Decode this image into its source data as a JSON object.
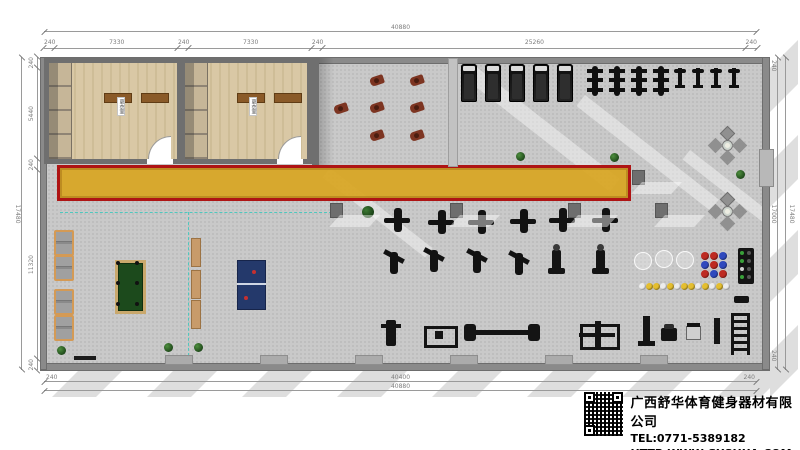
{
  "title_block": {
    "company_name": "广西舒华体育健身器材有限公司",
    "tel": "TEL:0771-5389182",
    "website": "HTTP:WWW.GXSHUA.COM"
  },
  "dimensions": {
    "top_total": "40880",
    "top_segments": [
      "240",
      "7330",
      "240",
      "7330",
      "240",
      "25260",
      "240"
    ],
    "bottom_inner": "40400",
    "bottom_inner_left_end": "240",
    "bottom_inner_right_end": "240",
    "bottom_total": "40880",
    "left_total": "17480",
    "left_segments": [
      "240",
      "5440",
      "240",
      "11320",
      "240"
    ],
    "right_inner": "17000",
    "right_outer": "17480",
    "right_top_end": "240",
    "right_bottom_end": "240"
  },
  "rooms": [
    {
      "label": "更衣室"
    },
    {
      "label": "更衣室"
    }
  ],
  "colors": {
    "track_fill": "#D8A626",
    "track_border": "#AE1414",
    "wood_floor": "#D8C7A4",
    "wall": "#8A8A8A",
    "floor": "#C9C9C9",
    "billiard_table": "#1C4A1C",
    "pingpong_table": "#24396B",
    "bench_wood": "#C89B6A",
    "zone_line": "#4FC8BE",
    "spin_bike": "#7D3522"
  },
  "plan": {
    "items": [
      {
        "t": "spin-bike",
        "x": 334,
        "y": 104
      },
      {
        "t": "spin-bike",
        "x": 370,
        "y": 76
      },
      {
        "t": "spin-bike",
        "x": 410,
        "y": 76
      },
      {
        "t": "spin-bike",
        "x": 370,
        "y": 103
      },
      {
        "t": "spin-bike",
        "x": 410,
        "y": 103
      },
      {
        "t": "spin-bike",
        "x": 370,
        "y": 131
      },
      {
        "t": "spin-bike",
        "x": 410,
        "y": 131
      },
      {
        "t": "treadmill",
        "x": 461,
        "y": 64
      },
      {
        "t": "treadmill",
        "x": 485,
        "y": 64
      },
      {
        "t": "treadmill",
        "x": 509,
        "y": 64
      },
      {
        "t": "treadmill",
        "x": 533,
        "y": 64
      },
      {
        "t": "treadmill",
        "x": 557,
        "y": 64
      },
      {
        "t": "elliptical",
        "x": 592,
        "y": 66
      },
      {
        "t": "elliptical",
        "x": 614,
        "y": 66
      },
      {
        "t": "elliptical",
        "x": 636,
        "y": 66
      },
      {
        "t": "elliptical",
        "x": 658,
        "y": 66
      },
      {
        "t": "gym-bike",
        "x": 678,
        "y": 68
      },
      {
        "t": "gym-bike",
        "x": 696,
        "y": 68
      },
      {
        "t": "gym-bike",
        "x": 714,
        "y": 68
      },
      {
        "t": "gym-bike",
        "x": 732,
        "y": 68
      },
      {
        "t": "machine-a",
        "x": 384,
        "y": 208
      },
      {
        "t": "machine-a",
        "x": 428,
        "y": 210
      },
      {
        "t": "machine-a",
        "x": 468,
        "y": 210
      },
      {
        "t": "machine-a",
        "x": 510,
        "y": 209
      },
      {
        "t": "machine-a",
        "x": 549,
        "y": 208
      },
      {
        "t": "machine-a",
        "x": 592,
        "y": 208
      },
      {
        "t": "machine-b",
        "x": 381,
        "y": 250
      },
      {
        "t": "machine-b",
        "x": 421,
        "y": 248
      },
      {
        "t": "machine-b",
        "x": 464,
        "y": 249
      },
      {
        "t": "machine-b",
        "x": 506,
        "y": 251
      },
      {
        "t": "pedestal",
        "x": 552,
        "y": 250
      },
      {
        "t": "pedestal",
        "x": 596,
        "y": 250
      },
      {
        "t": "bench-press",
        "x": 386,
        "y": 320
      },
      {
        "t": "plate-rack",
        "x": 424,
        "y": 326
      },
      {
        "t": "barbell-bench",
        "x": 470,
        "y": 330
      },
      {
        "t": "squat-rack",
        "x": 580,
        "y": 324
      },
      {
        "t": "post-a",
        "x": 643,
        "y": 316
      },
      {
        "t": "curl-bench",
        "x": 661,
        "y": 328
      },
      {
        "t": "chair-eq",
        "x": 686,
        "y": 326
      },
      {
        "t": "post-b",
        "x": 714,
        "y": 318
      },
      {
        "t": "ladder-rack",
        "x": 731,
        "y": 313
      },
      {
        "t": "db-rack",
        "x": 738,
        "y": 248
      },
      {
        "t": "small-eq",
        "x": 734,
        "y": 296
      },
      {
        "t": "doormat",
        "x": 74,
        "y": 356
      },
      {
        "t": "sofa",
        "x": 54,
        "y": 230
      },
      {
        "t": "sofa",
        "x": 54,
        "y": 255
      },
      {
        "t": "sofa",
        "x": 54,
        "y": 289
      },
      {
        "t": "sofa",
        "x": 54,
        "y": 315
      },
      {
        "t": "billiard",
        "x": 115,
        "y": 260
      },
      {
        "t": "pingpong",
        "x": 237,
        "y": 260
      },
      {
        "t": "wood-bench",
        "x": 191,
        "y": 238
      },
      {
        "t": "wood-bench",
        "x": 191,
        "y": 270
      },
      {
        "t": "wood-bench",
        "x": 191,
        "y": 300
      },
      {
        "t": "leisure",
        "x": 710,
        "y": 128
      },
      {
        "t": "leisure",
        "x": 710,
        "y": 194
      },
      {
        "t": "tree",
        "x": 362,
        "y": 206
      },
      {
        "t": "plant",
        "x": 610,
        "y": 153
      },
      {
        "t": "plant",
        "x": 516,
        "y": 152
      },
      {
        "t": "plant",
        "x": 736,
        "y": 170
      },
      {
        "t": "plant",
        "x": 57,
        "y": 346
      },
      {
        "t": "plant",
        "x": 164,
        "y": 343
      },
      {
        "t": "plant",
        "x": 194,
        "y": 343
      },
      {
        "t": "col",
        "x": 330,
        "y": 203
      },
      {
        "t": "col",
        "x": 450,
        "y": 203
      },
      {
        "t": "col",
        "x": 568,
        "y": 203
      },
      {
        "t": "col",
        "x": 655,
        "y": 203
      },
      {
        "t": "col",
        "x": 632,
        "y": 170
      },
      {
        "t": "pilaster",
        "x": 165,
        "y": 355
      },
      {
        "t": "pilaster",
        "x": 260,
        "y": 355
      },
      {
        "t": "pilaster",
        "x": 355,
        "y": 355
      },
      {
        "t": "pilaster",
        "x": 450,
        "y": 355
      },
      {
        "t": "pilaster",
        "x": 545,
        "y": 355
      },
      {
        "t": "pilaster",
        "x": 640,
        "y": 355
      },
      {
        "t": "ghost-ball",
        "x": 634,
        "y": 252
      },
      {
        "t": "ghost-ball",
        "x": 655,
        "y": 250
      },
      {
        "t": "ghost-ball",
        "x": 676,
        "y": 251
      },
      {
        "t": "ball",
        "x": 701,
        "y": 252,
        "w": 8,
        "h": 8,
        "c": "#BE2B22"
      },
      {
        "t": "ball",
        "x": 710,
        "y": 252,
        "w": 8,
        "h": 8,
        "c": "#BE2B22"
      },
      {
        "t": "ball",
        "x": 719,
        "y": 252,
        "w": 8,
        "h": 8,
        "c": "#2F49BE"
      },
      {
        "t": "ball",
        "x": 701,
        "y": 261,
        "w": 8,
        "h": 8,
        "c": "#2F49BE"
      },
      {
        "t": "ball",
        "x": 710,
        "y": 261,
        "w": 8,
        "h": 8,
        "c": "#BE2B22"
      },
      {
        "t": "ball",
        "x": 719,
        "y": 261,
        "w": 8,
        "h": 8,
        "c": "#2F49BE"
      },
      {
        "t": "ball",
        "x": 701,
        "y": 270,
        "w": 8,
        "h": 8,
        "c": "#BE2B22"
      },
      {
        "t": "ball",
        "x": 710,
        "y": 270,
        "w": 8,
        "h": 8,
        "c": "#2F49BE"
      },
      {
        "t": "ball",
        "x": 719,
        "y": 270,
        "w": 8,
        "h": 8,
        "c": "#BE2B22"
      },
      {
        "t": "ball",
        "x": 639,
        "y": 283,
        "w": 7,
        "h": 7,
        "c": "#ECECEC"
      },
      {
        "t": "ball",
        "x": 646,
        "y": 283,
        "w": 7,
        "h": 7,
        "c": "#E4BE2F"
      },
      {
        "t": "ball",
        "x": 653,
        "y": 283,
        "w": 7,
        "h": 7,
        "c": "#E4BE2F"
      },
      {
        "t": "ball",
        "x": 660,
        "y": 283,
        "w": 7,
        "h": 7,
        "c": "#ECECEC"
      },
      {
        "t": "ball",
        "x": 667,
        "y": 283,
        "w": 7,
        "h": 7,
        "c": "#E4BE2F"
      },
      {
        "t": "ball",
        "x": 674,
        "y": 283,
        "w": 7,
        "h": 7,
        "c": "#ECECEC"
      },
      {
        "t": "ball",
        "x": 681,
        "y": 283,
        "w": 7,
        "h": 7,
        "c": "#E4BE2F"
      },
      {
        "t": "ball",
        "x": 688,
        "y": 283,
        "w": 7,
        "h": 7,
        "c": "#E4BE2F"
      },
      {
        "t": "ball",
        "x": 695,
        "y": 283,
        "w": 7,
        "h": 7,
        "c": "#ECECEC"
      },
      {
        "t": "ball",
        "x": 702,
        "y": 283,
        "w": 7,
        "h": 7,
        "c": "#E4BE2F"
      },
      {
        "t": "ball",
        "x": 709,
        "y": 283,
        "w": 7,
        "h": 7,
        "c": "#ECECEC"
      },
      {
        "t": "ball",
        "x": 716,
        "y": 283,
        "w": 7,
        "h": 7,
        "c": "#E4BE2F"
      },
      {
        "t": "ball",
        "x": 723,
        "y": 283,
        "w": 7,
        "h": 7,
        "c": "#ECECEC"
      }
    ]
  }
}
